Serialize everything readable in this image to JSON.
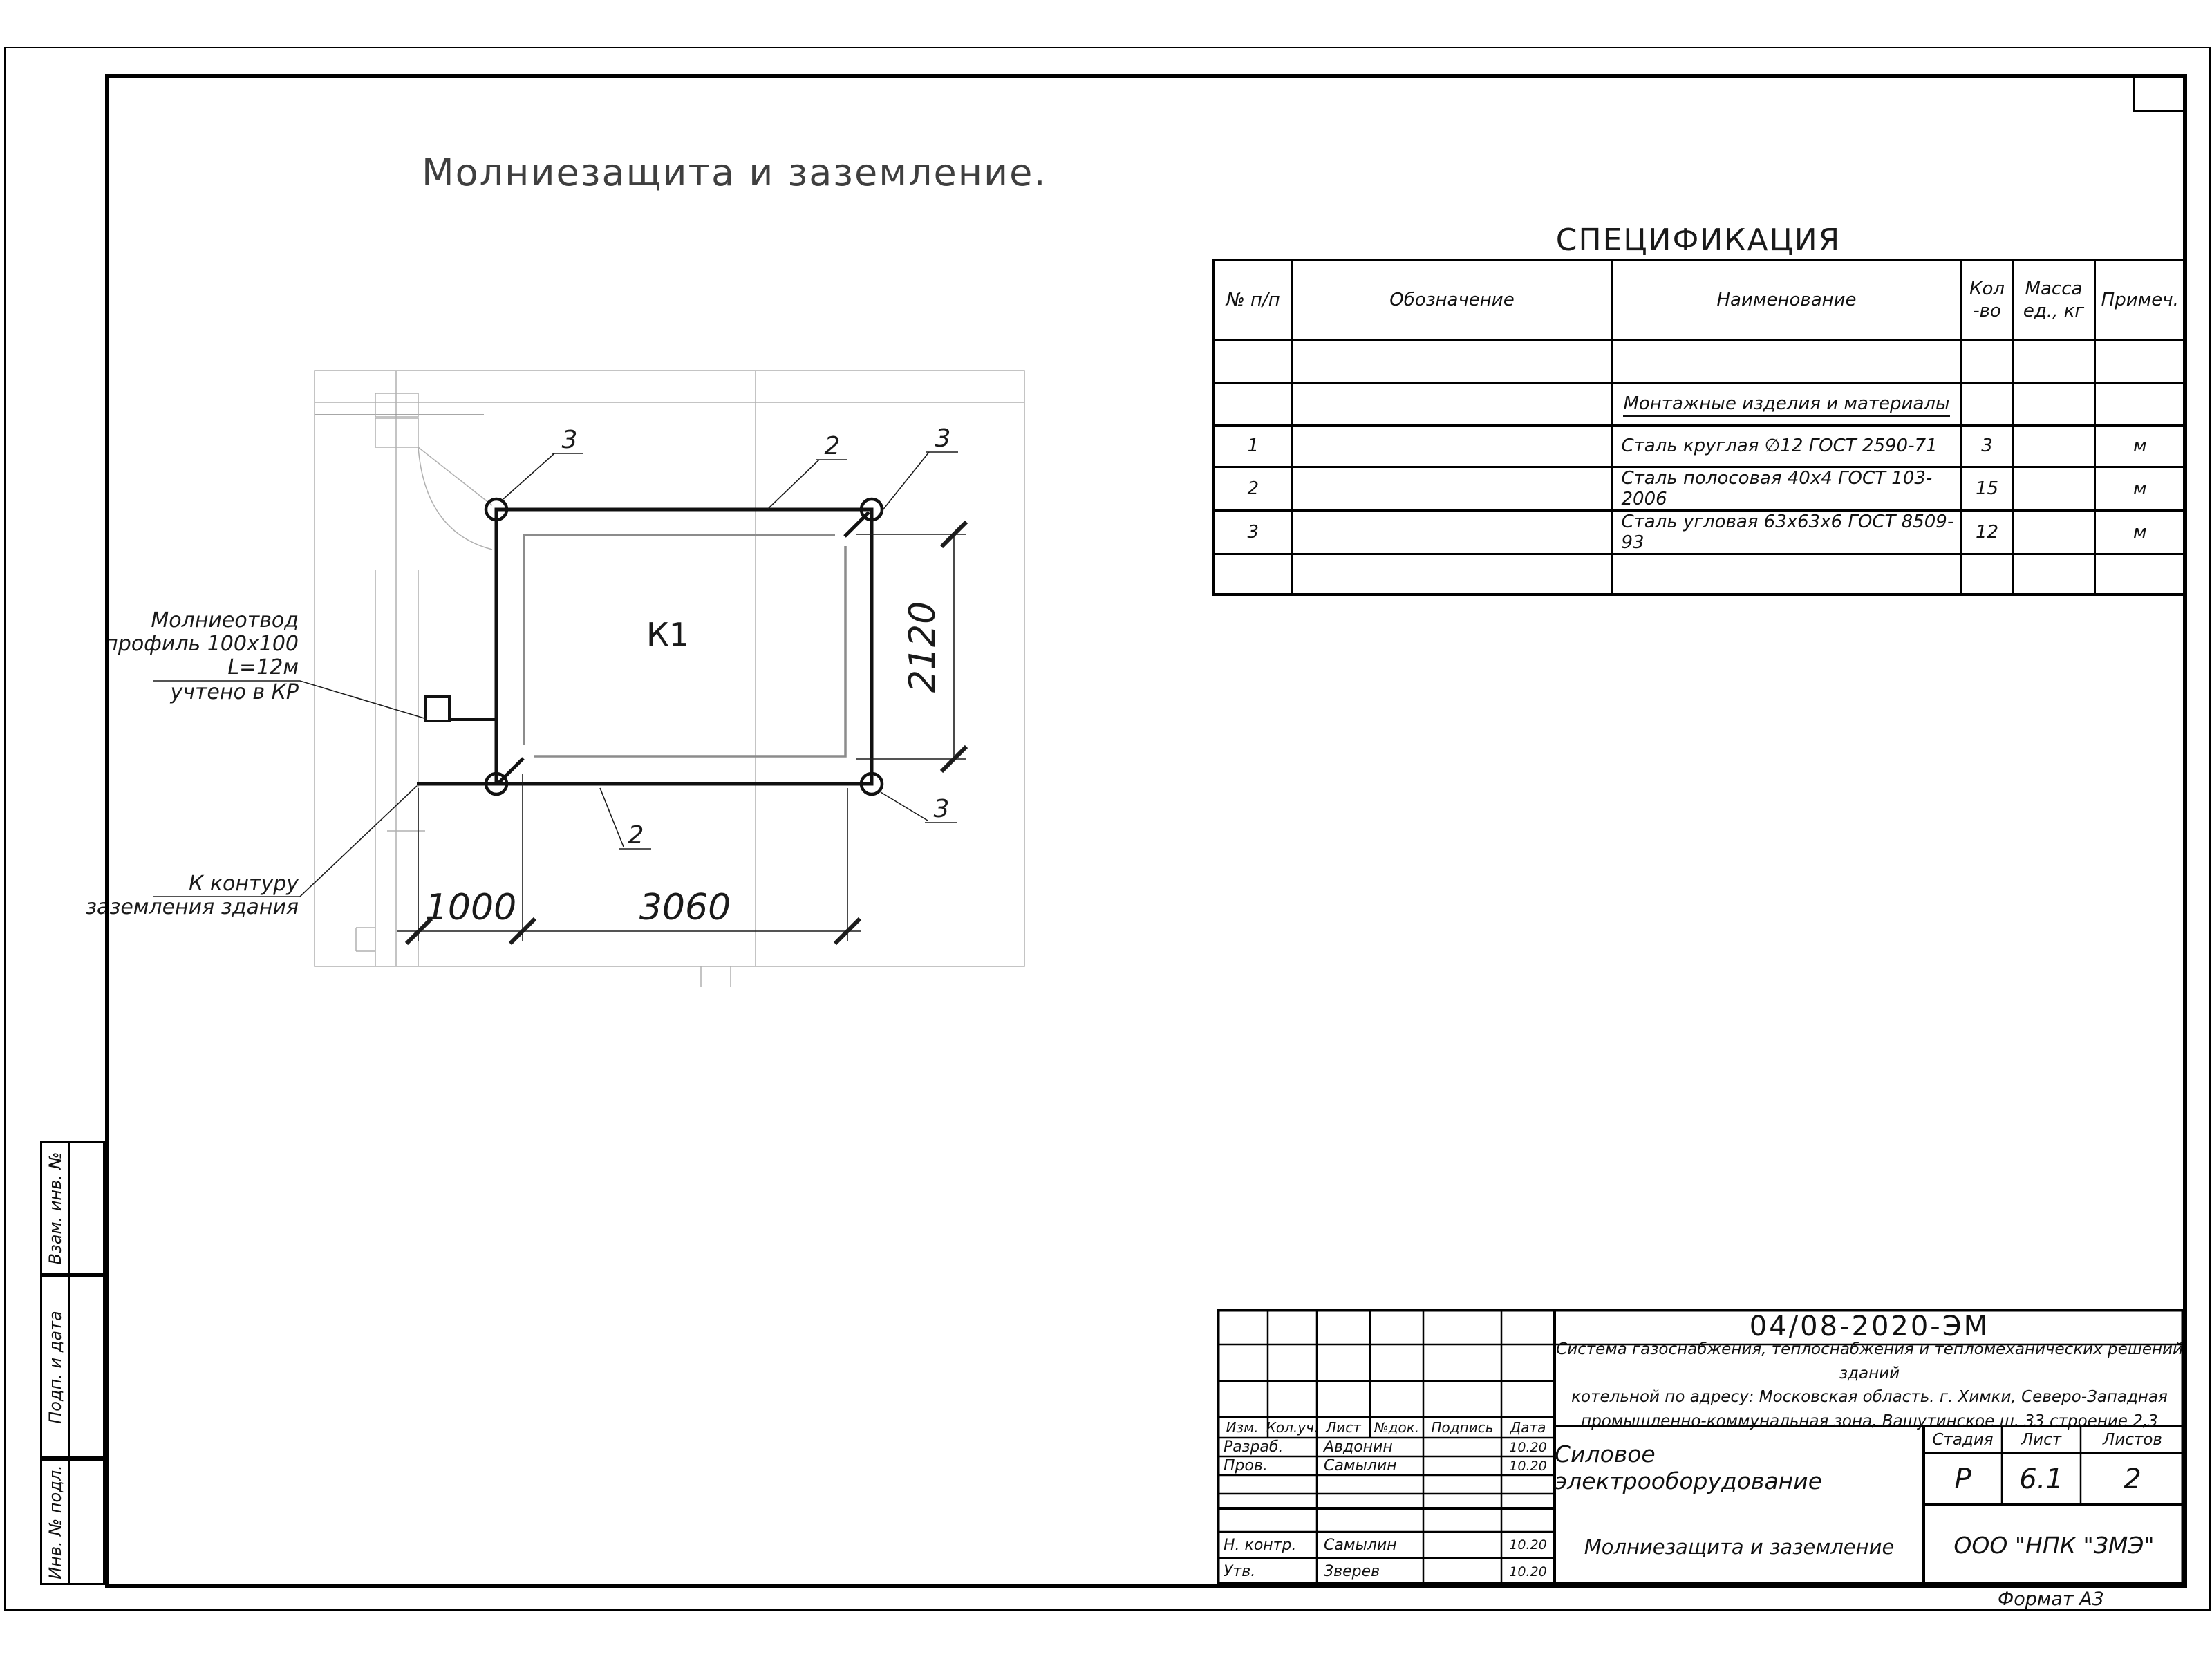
{
  "sheet": {
    "title": "Молниезащита и заземление.",
    "format_note": "Формат А3"
  },
  "spec_table": {
    "heading": "СПЕЦИФИКАЦИЯ",
    "columns": {
      "num": "№ п/п",
      "designation": "Обозначение",
      "name": "Наименование",
      "qty": "Кол\n-во",
      "mass": "Масса\nед., кг",
      "note": "Примеч."
    },
    "section_header": "Монтажные изделия и материалы",
    "rows": [
      {
        "num": "1",
        "name": "Сталь круглая ∅12 ГОСТ 2590-71",
        "qty": "3",
        "note": "м"
      },
      {
        "num": "2",
        "name": "Сталь полосовая 40х4 ГОСТ 103-2006",
        "qty": "15",
        "note": "м"
      },
      {
        "num": "3",
        "name": "Сталь угловая 63х63х6 ГОСТ 8509-93",
        "qty": "12",
        "note": "м"
      }
    ]
  },
  "drawing": {
    "building_label": "К1",
    "dimensions": {
      "height": "2120",
      "offset": "1000",
      "width": "3060"
    },
    "callouts": {
      "top_left": "3",
      "top_mid": "2",
      "top_right": "3",
      "bottom": "2",
      "bottom_right": "3"
    },
    "rod_note": {
      "line1": "Молниеотвод",
      "line2": "профиль 100х100",
      "line3": "L=12м",
      "line4": "учтено в КР"
    },
    "ground_note": {
      "line1": "К контуру",
      "line2": "заземления здания"
    }
  },
  "title_block": {
    "doc_number": "04/08-2020-ЭМ",
    "description": "Система газоснабжения, теплоснабжения и тепломеханических решений зданий\nкотельной по адресу: Московская область. г. Химки, Северо-Западная\nпромышленно-коммунальная зона, Вашутинское ш. 33 строение 2,3",
    "rev_header": {
      "izm": "Изм.",
      "koluch": "Кол.уч.",
      "list": "Лист",
      "ndok": "№док.",
      "podpis": "Подпись",
      "data": "Дата"
    },
    "signatures": [
      {
        "role": "Разраб.",
        "name": "Авдонин",
        "date": "10.20"
      },
      {
        "role": "Пров.",
        "name": "Самылин",
        "date": "10.20"
      },
      {
        "role": "Н. контр.",
        "name": "Самылин",
        "date": "10.20"
      },
      {
        "role": "Утв.",
        "name": "Зверев",
        "date": "10.20"
      }
    ],
    "project_name": "Силовое электрооборудование",
    "sheet_name": "Молниезащита и заземление",
    "company": "ООО \"НПК \"ЗМЭ\"",
    "stage": {
      "label": "Стадия",
      "value": "Р"
    },
    "sheet_no": {
      "label": "Лист",
      "value": "6.1"
    },
    "sheets_total": {
      "label": "Листов",
      "value": "2"
    }
  },
  "side_stamp": {
    "labels": [
      "Взам. инв. №",
      "Подп. и дата",
      "Инв. № подл."
    ]
  }
}
